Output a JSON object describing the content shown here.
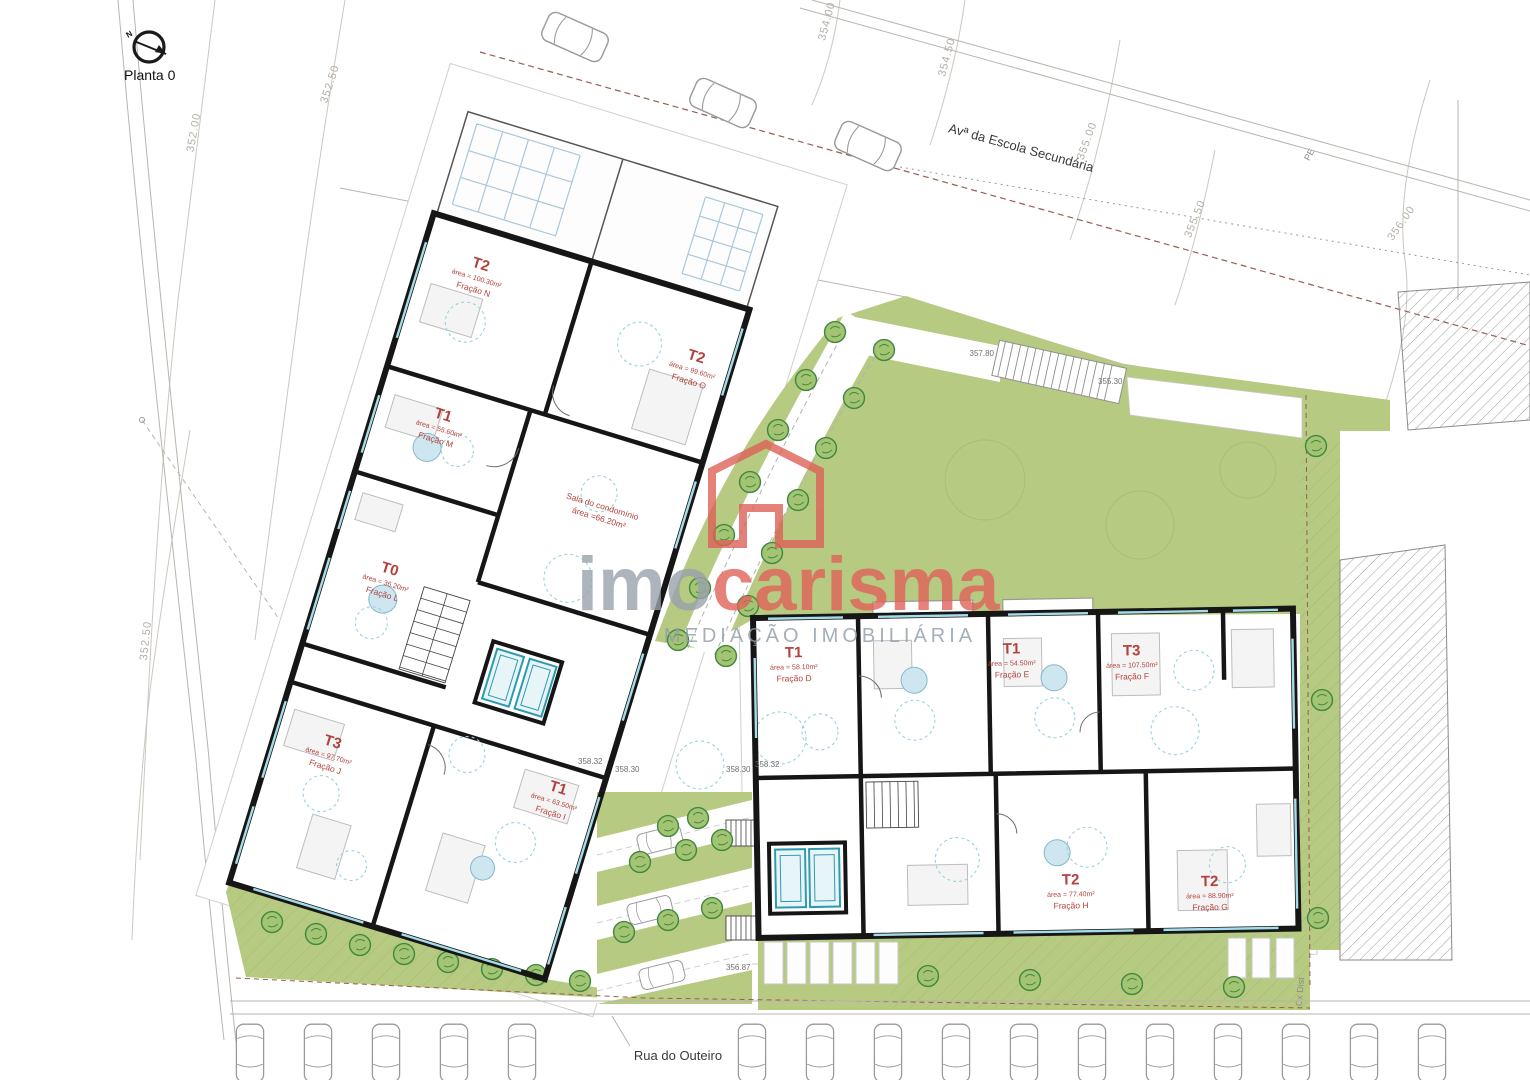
{
  "plan": {
    "label": "Planta 0",
    "north_letter": "N"
  },
  "streets": {
    "top": "Avª da Escola Secundária",
    "bottom": "Rua do Outeiro",
    "box": "Cx Dist"
  },
  "contours": {
    "c352": "352.00",
    "c3525a": "352.50",
    "c3525b": "352.50",
    "c354": "354.00",
    "c3545": "354.50",
    "c355": "355.00",
    "c3555": "355.50",
    "c356": "356.00",
    "pe": "PE"
  },
  "levels": {
    "walk_top": "357.80",
    "walk_bottom": "355.30",
    "l1": "358.32",
    "l2": "358.30",
    "l3": "358.30",
    "l4": "358.32",
    "street": "356.87"
  },
  "condo": {
    "name": "Sala do condomínio",
    "area": "área =66.20m²"
  },
  "units": {
    "n": {
      "type": "T2",
      "area": "área = 100.30m²",
      "fraction": "Fração N"
    },
    "o": {
      "type": "T2",
      "area": "área = 99.60m²",
      "fraction": "Fração O"
    },
    "m": {
      "type": "T1",
      "area": "área = 55.60m²",
      "fraction": "Fração M"
    },
    "l": {
      "type": "T0",
      "area": "área = 36.20m²",
      "fraction": "Fração L"
    },
    "j": {
      "type": "T3",
      "area": "área = 97.70m²",
      "fraction": "Fração J"
    },
    "i": {
      "type": "T1",
      "area": "área = 63.50m²",
      "fraction": "Fração I"
    },
    "d": {
      "type": "T1",
      "area": "área = 58.10m²",
      "fraction": "Fração D"
    },
    "e": {
      "type": "T1",
      "area": "área = 54.50m²",
      "fraction": "Fração E"
    },
    "f": {
      "type": "T3",
      "area": "área = 107.50m²",
      "fraction": "Fração F"
    },
    "h": {
      "type": "T2",
      "area": "área = 77.40m²",
      "fraction": "Fração H"
    },
    "g": {
      "type": "T2",
      "area": "área = 88.90m²",
      "fraction": "Fração G"
    }
  },
  "watermark": {
    "imo": "imo",
    "carisma": "carisma",
    "tagline": "MEDIAÇÃO IMOBILIÁRIA"
  },
  "colors": {
    "green": "#b6ca82",
    "tree": "#41873e",
    "unit_label": "#b2423c",
    "watermark_red": "#e0635a",
    "watermark_gray": "#9aa2ac",
    "elevator": "#2e9ab0",
    "wall": "#161616"
  }
}
